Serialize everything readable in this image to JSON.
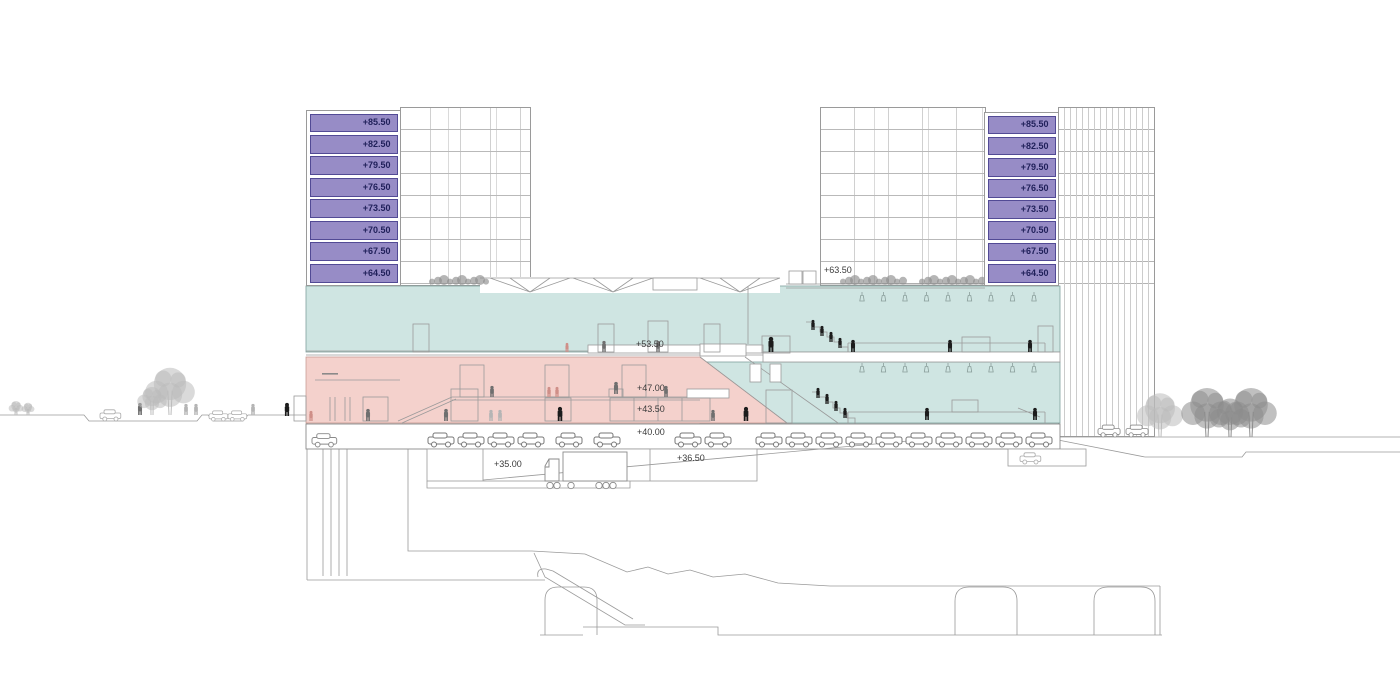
{
  "drawing": {
    "type": "architectural-cross-section",
    "tower_levels": [
      "+85.50",
      "+82.50",
      "+79.50",
      "+76.50",
      "+73.50",
      "+70.50",
      "+67.50",
      "+64.50"
    ],
    "section_levels": [
      {
        "id": "roof-terrace",
        "label": "+63.50"
      },
      {
        "id": "hall",
        "label": "+53.50"
      },
      {
        "id": "upper-concourse",
        "label": "+47.00"
      },
      {
        "id": "lower-concourse",
        "label": "+43.50"
      },
      {
        "id": "parking",
        "label": "+40.00"
      },
      {
        "id": "dock-low",
        "label": "+35.00"
      },
      {
        "id": "dock-high",
        "label": "+36.50"
      }
    ],
    "colors": {
      "level_band_fill": "#978cc6",
      "level_band_border": "#524a95",
      "level_band_text": "#20205a",
      "hall_fill": "#cfe5e2",
      "concourse_fill": "#f4d1cc",
      "linework": "#9a9a9a",
      "label_text": "#3a3a3a",
      "figure": {
        "k": "#1c1c1c",
        "d": "#6f6f6f",
        "l": "#b5b5b5",
        "p": "#cf8f88"
      },
      "tree": {
        "l": "#bcbcbc",
        "d": "#8d8d8d"
      }
    },
    "people": [
      {
        "x": 140,
        "y": 415,
        "h": 12,
        "c": "d"
      },
      {
        "x": 186,
        "y": 415,
        "h": 11,
        "c": "l"
      },
      {
        "x": 196,
        "y": 415,
        "h": 11,
        "c": "l"
      },
      {
        "x": 253,
        "y": 415,
        "h": 11,
        "c": "l"
      },
      {
        "x": 287,
        "y": 416,
        "h": 13,
        "c": "k"
      },
      {
        "x": 311,
        "y": 421,
        "h": 10,
        "c": "p"
      },
      {
        "x": 567,
        "y": 352,
        "h": 9,
        "c": "p"
      },
      {
        "x": 604,
        "y": 352,
        "h": 11,
        "c": "d"
      },
      {
        "x": 658,
        "y": 352,
        "h": 11,
        "c": "d"
      },
      {
        "x": 771,
        "y": 352,
        "h": 15,
        "c": "k"
      },
      {
        "x": 813,
        "y": 330,
        "h": 10,
        "c": "k"
      },
      {
        "x": 822,
        "y": 336,
        "h": 10,
        "c": "k"
      },
      {
        "x": 831,
        "y": 342,
        "h": 10,
        "c": "k"
      },
      {
        "x": 840,
        "y": 348,
        "h": 10,
        "c": "k"
      },
      {
        "x": 853,
        "y": 352,
        "h": 12,
        "c": "k"
      },
      {
        "x": 950,
        "y": 352,
        "h": 12,
        "c": "k"
      },
      {
        "x": 1030,
        "y": 352,
        "h": 12,
        "c": "k"
      },
      {
        "x": 492,
        "y": 397,
        "h": 11,
        "c": "d"
      },
      {
        "x": 549,
        "y": 397,
        "h": 10,
        "c": "p"
      },
      {
        "x": 557,
        "y": 397,
        "h": 10,
        "c": "p"
      },
      {
        "x": 616,
        "y": 394,
        "h": 12,
        "c": "d"
      },
      {
        "x": 666,
        "y": 397,
        "h": 11,
        "c": "d"
      },
      {
        "x": 368,
        "y": 421,
        "h": 12,
        "c": "d"
      },
      {
        "x": 446,
        "y": 421,
        "h": 12,
        "c": "d"
      },
      {
        "x": 491,
        "y": 421,
        "h": 11,
        "c": "l"
      },
      {
        "x": 500,
        "y": 421,
        "h": 11,
        "c": "l"
      },
      {
        "x": 560,
        "y": 421,
        "h": 14,
        "c": "k"
      },
      {
        "x": 713,
        "y": 421,
        "h": 11,
        "c": "d"
      },
      {
        "x": 746,
        "y": 421,
        "h": 14,
        "c": "k"
      },
      {
        "x": 818,
        "y": 398,
        "h": 10,
        "c": "k"
      },
      {
        "x": 827,
        "y": 404,
        "h": 10,
        "c": "k"
      },
      {
        "x": 836,
        "y": 411,
        "h": 10,
        "c": "k"
      },
      {
        "x": 845,
        "y": 418,
        "h": 10,
        "c": "k"
      },
      {
        "x": 927,
        "y": 420,
        "h": 12,
        "c": "k"
      },
      {
        "x": 1035,
        "y": 420,
        "h": 12,
        "c": "k"
      }
    ],
    "parked_cars": [
      428,
      458,
      488,
      518,
      556,
      594,
      675,
      705,
      756,
      786,
      816,
      846,
      876,
      906,
      936,
      966,
      996,
      1026
    ],
    "street_cars": [
      {
        "x": 100,
        "y": 421,
        "s": 0.8,
        "tone": "light"
      },
      {
        "x": 209,
        "y": 421,
        "s": 0.72,
        "tone": "light"
      },
      {
        "x": 228,
        "y": 421,
        "s": 0.72,
        "tone": "light"
      },
      {
        "x": 312,
        "y": 447,
        "s": 0.95,
        "tone": "mid"
      },
      {
        "x": 1020,
        "y": 464,
        "s": 0.8,
        "tone": "light"
      },
      {
        "x": 1098,
        "y": 437,
        "s": 0.85,
        "tone": "mid"
      },
      {
        "x": 1126,
        "y": 437,
        "s": 0.85,
        "tone": "mid"
      }
    ],
    "trees": [
      {
        "x": 16,
        "y": 415,
        "r": 8,
        "s": "l"
      },
      {
        "x": 28,
        "y": 415,
        "r": 7,
        "s": "l"
      },
      {
        "x": 152,
        "y": 415,
        "r": 16,
        "s": "l"
      },
      {
        "x": 170,
        "y": 415,
        "r": 27,
        "s": "l"
      },
      {
        "x": 1160,
        "y": 437,
        "r": 25,
        "s": "l"
      },
      {
        "x": 1207,
        "y": 437,
        "r": 28,
        "s": "d"
      },
      {
        "x": 1230,
        "y": 437,
        "r": 22,
        "s": "d"
      },
      {
        "x": 1251,
        "y": 437,
        "r": 28,
        "s": "d"
      }
    ],
    "shrub_rows": [
      {
        "x1": 843,
        "x2": 903,
        "y": 284
      },
      {
        "x1": 922,
        "x2": 984,
        "y": 284
      },
      {
        "x1": 432,
        "x2": 486,
        "y": 284
      }
    ],
    "pendant_rows": [
      {
        "y": 292,
        "x0": 862,
        "n": 9,
        "dx": 21.5
      },
      {
        "y": 363,
        "x0": 862,
        "n": 9,
        "dx": 21.5
      }
    ],
    "doors": [
      [
        413,
        324,
        16,
        28
      ],
      [
        598,
        324,
        16,
        28
      ],
      [
        648,
        321,
        20,
        31
      ],
      [
        704,
        324,
        16,
        28
      ],
      [
        1038,
        326,
        15,
        26
      ],
      [
        762,
        336,
        28,
        17
      ],
      [
        460,
        365,
        24,
        32
      ],
      [
        545,
        365,
        24,
        32
      ],
      [
        622,
        365,
        24,
        32
      ],
      [
        363,
        397,
        25,
        24
      ],
      [
        451,
        389,
        27,
        32
      ],
      [
        545,
        398,
        26,
        23
      ],
      [
        610,
        398,
        100,
        23
      ],
      [
        766,
        390,
        26,
        33
      ],
      [
        294,
        396,
        12,
        25
      ]
    ]
  }
}
